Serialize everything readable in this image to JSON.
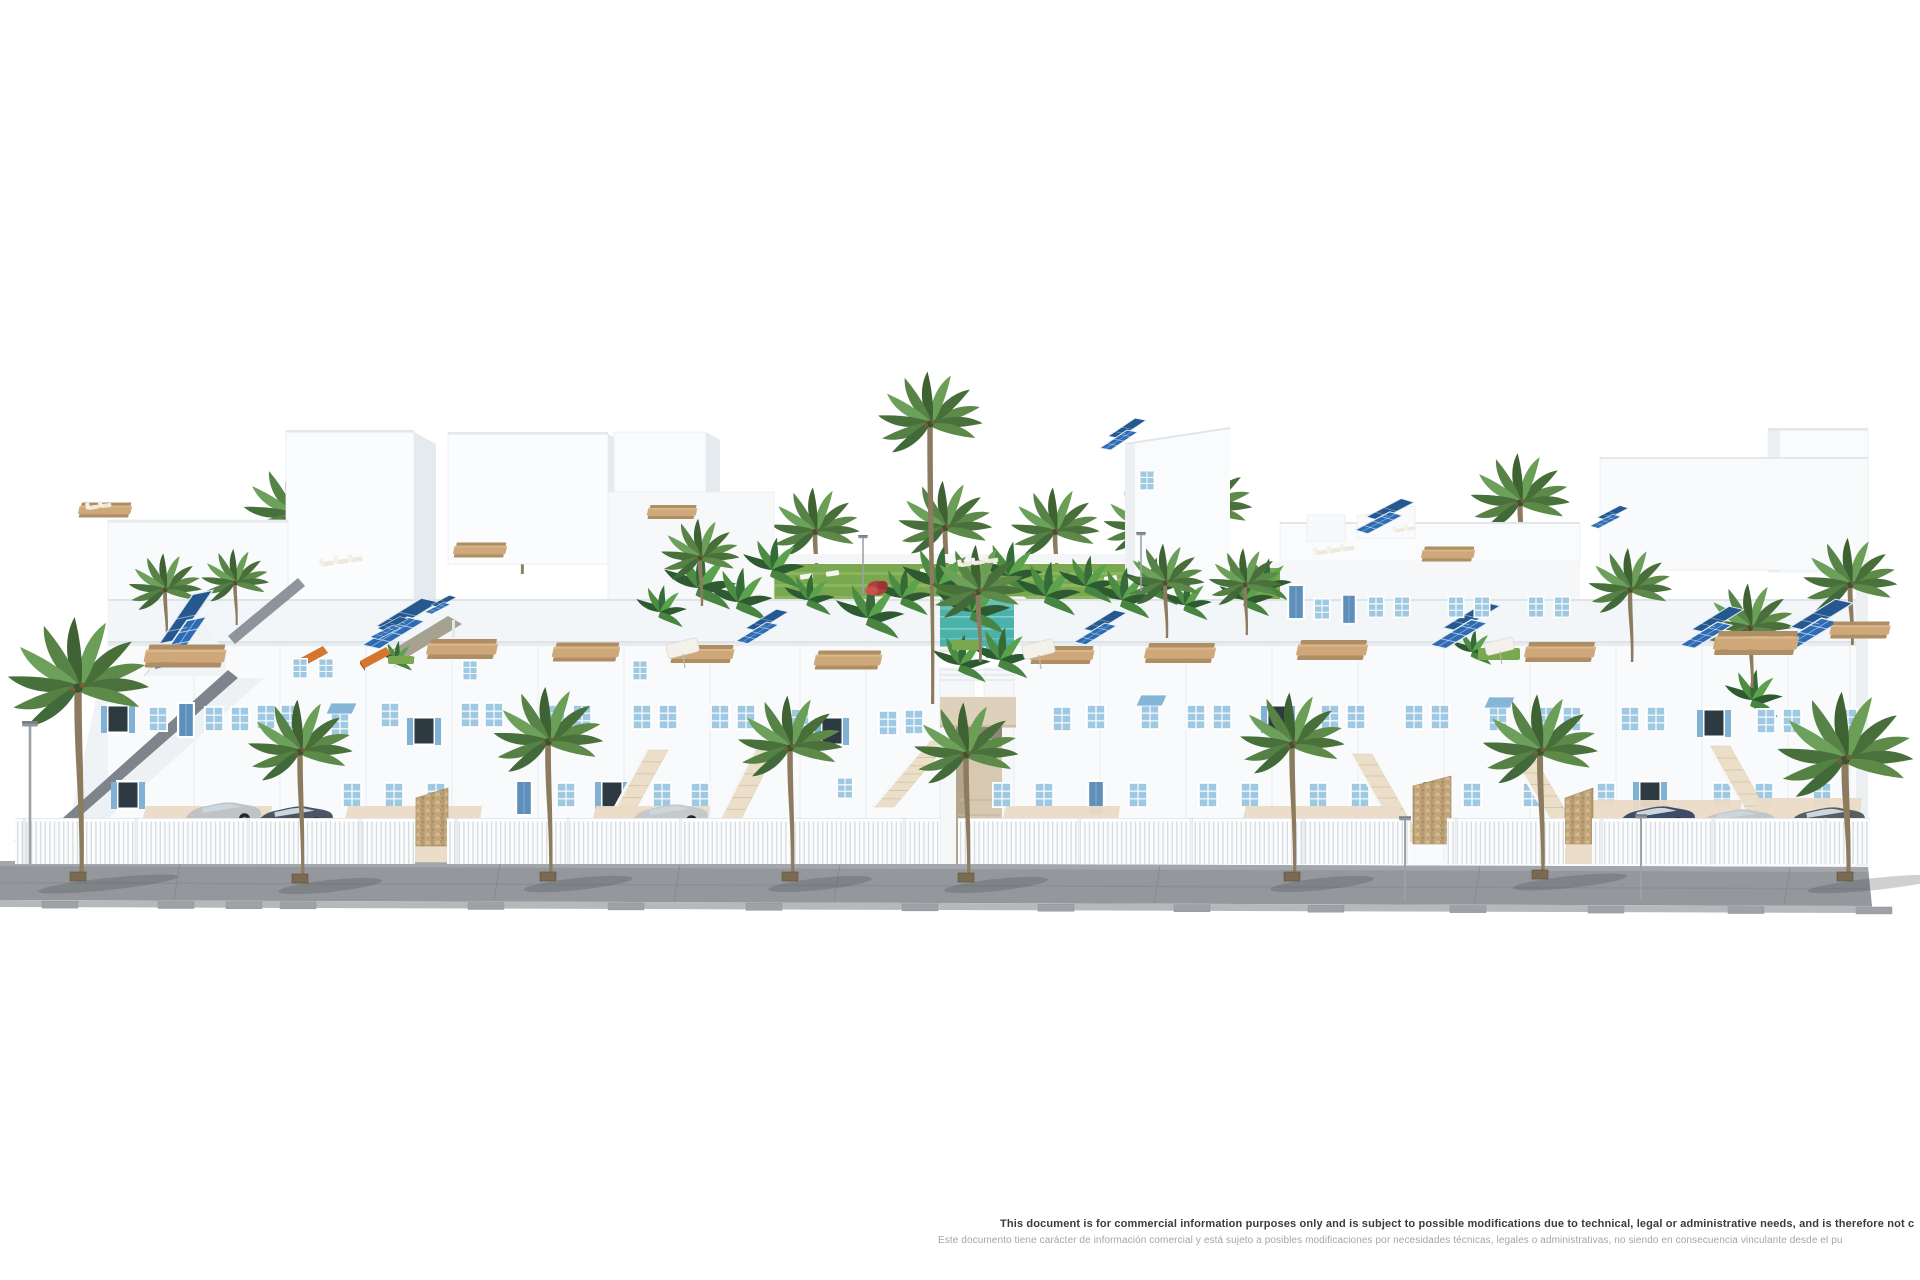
{
  "image": {
    "description": "3D architectural rendering of a white Mediterranean-style residential complex with blue shuttered windows, rooftop terraces with wooden dining tables, solar panels, a central landscaped courtyard with turquoise swimming pool, palm trees, white picket fence, driveways with parked cars and a gray paved sidewalk",
    "background": "#ffffff",
    "width": 1920,
    "height": 1280
  },
  "disclaimer": {
    "line1": "This document is for commercial information purposes only and is subject to possible modifications due to technical, legal or administrative needs, and is therefore not c",
    "line2": "Este documento tiene carácter de información comercial y está sujeto a posibles modificaciones por necesidades técnicas, legales o administrativas, no siendo en consecuencia vinculante desde el pu"
  },
  "palette": {
    "wall_white": "#f8fafb",
    "wall_band": "#f3f6f8",
    "wall_shade": "#e5eaee",
    "window_blue": "#9fc9e2",
    "shutter_blue": "#7fb2d4",
    "door_blue": "#5d8fba",
    "solar_blue": "#2d6cb4",
    "solar_dark": "#24588f",
    "palm_green": "#5d8a49",
    "palm_trunk": "#8d7b5f",
    "pool_teal": "#4db1ab",
    "lawn_green": "#7aa851",
    "terrace_sand": "#efe8da",
    "stair_sand": "#ecdfc9",
    "stone_tan": "#c5aa80",
    "road_gray": "#94979b",
    "curb_gray": "#b6b9bc",
    "wood_tan": "#cfa87a",
    "awning_orange": "#d4762e",
    "pergola_olive": "#a5a291"
  },
  "scene": {
    "palms_back": [
      [
        293,
        515,
        0.95,
        70
      ],
      [
        520,
        512,
        0.9,
        62
      ],
      [
        815,
        532,
        0.85,
        58
      ],
      [
        945,
        528,
        0.9,
        58
      ],
      [
        1055,
        532,
        0.85,
        55
      ],
      [
        1145,
        528,
        0.8,
        52
      ],
      [
        1205,
        508,
        0.9,
        60
      ],
      [
        1520,
        503,
        0.95,
        65
      ]
    ],
    "palms_mid": [
      [
        930,
        424,
        1.0,
        280
      ],
      [
        978,
        592,
        0.9,
        70
      ],
      [
        1165,
        583,
        0.75,
        55
      ],
      [
        700,
        558,
        0.75,
        48
      ],
      [
        165,
        590,
        0.7,
        48
      ],
      [
        235,
        583,
        0.65,
        42
      ],
      [
        1630,
        590,
        0.8,
        72
      ],
      [
        1750,
        628,
        0.85,
        60
      ],
      [
        1850,
        585,
        0.9,
        60
      ],
      [
        1245,
        585,
        0.7,
        50
      ]
    ],
    "palms_front": [
      [
        78,
        688,
        1.35,
        190
      ],
      [
        300,
        752,
        1.0,
        128
      ],
      [
        548,
        742,
        1.05,
        136
      ],
      [
        790,
        748,
        1.0,
        130
      ],
      [
        966,
        755,
        1.0,
        124
      ],
      [
        1292,
        745,
        1.0,
        133
      ],
      [
        1540,
        752,
        1.1,
        124
      ],
      [
        1845,
        760,
        1.3,
        118
      ]
    ],
    "bananas": [
      [
        698,
        588,
        1
      ],
      [
        738,
        602,
        0.9
      ],
      [
        772,
        570,
        0.85
      ],
      [
        808,
        600,
        0.7
      ],
      [
        868,
        618,
        0.95
      ],
      [
        902,
        598,
        0.8
      ],
      [
        938,
        586,
        1.05
      ],
      [
        972,
        612,
        1
      ],
      [
        1008,
        576,
        0.9
      ],
      [
        1046,
        596,
        0.9
      ],
      [
        1086,
        586,
        0.8
      ],
      [
        1122,
        600,
        0.85
      ],
      [
        1152,
        588,
        0.8
      ],
      [
        660,
        612,
        0.7
      ],
      [
        1185,
        605,
        0.7
      ],
      [
        960,
        665,
        0.8
      ],
      [
        1000,
        660,
        0.85
      ],
      [
        1245,
        600,
        0.75
      ],
      [
        1265,
        585,
        0.7
      ],
      [
        1472,
        652,
        0.6
      ],
      [
        396,
        660,
        0.5
      ],
      [
        1752,
        700,
        0.8
      ]
    ],
    "red_bushes": [
      [
        877,
        588,
        0.9
      ]
    ],
    "lawn_patches": [
      [
        952,
        640,
        30,
        10
      ],
      [
        1478,
        648,
        42,
        12
      ],
      [
        388,
        656,
        26,
        8
      ]
    ],
    "solar_arrays": [
      [
        153,
        670,
        1.3,
        -38
      ],
      [
        362,
        645,
        1.15,
        -14
      ],
      [
        736,
        641,
        0.78,
        -14
      ],
      [
        1074,
        642,
        0.78,
        -14
      ],
      [
        1430,
        645,
        1.05,
        -14
      ],
      [
        1680,
        645,
        0.95,
        -14
      ],
      [
        1776,
        646,
        1.15,
        -14
      ],
      [
        1100,
        448,
        0.7,
        -16
      ],
      [
        1355,
        530,
        0.85,
        -10
      ],
      [
        1590,
        526,
        0.55,
        -10
      ],
      [
        370,
        637,
        0.55,
        -10
      ],
      [
        425,
        612,
        0.45,
        -10
      ]
    ],
    "tables": [
      [
        185,
        656,
        1.15
      ],
      [
        462,
        649,
        1.0
      ],
      [
        586,
        652,
        0.95
      ],
      [
        702,
        654,
        0.9
      ],
      [
        848,
        660,
        0.95
      ],
      [
        1062,
        655,
        0.9
      ],
      [
        1180,
        653,
        1.0
      ],
      [
        1332,
        650,
        1.0
      ],
      [
        1560,
        652,
        1.0
      ],
      [
        1756,
        643,
        1.2
      ],
      [
        1860,
        630,
        0.85
      ],
      [
        480,
        550,
        0.75
      ],
      [
        672,
        512,
        0.7
      ],
      [
        105,
        510,
        0.75
      ],
      [
        1448,
        554,
        0.75
      ]
    ],
    "loungers": [
      [
        322,
        562,
        0.9,
        3
      ],
      [
        960,
        563,
        0.85,
        3
      ],
      [
        1316,
        551,
        0.85,
        3
      ],
      [
        1395,
        529,
        0.7,
        2
      ],
      [
        88,
        506,
        0.8,
        2
      ]
    ],
    "parasols": [
      [
        683,
        650,
        1
      ],
      [
        1039,
        651,
        1
      ],
      [
        1500,
        648,
        0.9
      ]
    ],
    "awnings_orange": [
      [
        297,
        660
      ],
      [
        360,
        661
      ]
    ],
    "windows": [
      [
        118,
        704,
        "s"
      ],
      [
        158,
        706,
        "p"
      ],
      [
        186,
        702,
        "d"
      ],
      [
        214,
        706,
        "p"
      ],
      [
        240,
        706,
        "p"
      ],
      [
        266,
        704,
        "p"
      ],
      [
        290,
        704,
        "p"
      ],
      [
        340,
        712,
        "a"
      ],
      [
        390,
        702,
        "p"
      ],
      [
        424,
        716,
        "s"
      ],
      [
        470,
        702,
        "p"
      ],
      [
        494,
        702,
        "p"
      ],
      [
        556,
        704,
        "p"
      ],
      [
        582,
        704,
        "p"
      ],
      [
        642,
        704,
        "p"
      ],
      [
        668,
        704,
        "p"
      ],
      [
        720,
        704,
        "p"
      ],
      [
        746,
        704,
        "p"
      ],
      [
        800,
        708,
        "p"
      ],
      [
        832,
        716,
        "s"
      ],
      [
        888,
        710,
        "p"
      ],
      [
        914,
        709,
        "p"
      ],
      [
        1062,
        706,
        "p"
      ],
      [
        1096,
        704,
        "p"
      ],
      [
        1150,
        704,
        "a"
      ],
      [
        1196,
        704,
        "p"
      ],
      [
        1222,
        704,
        "p"
      ],
      [
        1278,
        704,
        "s"
      ],
      [
        1330,
        704,
        "p"
      ],
      [
        1356,
        704,
        "p"
      ],
      [
        1414,
        704,
        "p"
      ],
      [
        1440,
        704,
        "p"
      ],
      [
        1498,
        706,
        "a"
      ],
      [
        1546,
        706,
        "p"
      ],
      [
        1572,
        706,
        "p"
      ],
      [
        1630,
        706,
        "p"
      ],
      [
        1656,
        706,
        "p"
      ],
      [
        1714,
        708,
        "s"
      ],
      [
        1766,
        708,
        "p"
      ],
      [
        1792,
        708,
        "p"
      ],
      [
        1848,
        708,
        "p"
      ],
      [
        1296,
        584,
        "d",
        1.0
      ],
      [
        1322,
        598,
        "p",
        0.85
      ],
      [
        1349,
        594,
        "d",
        0.85
      ],
      [
        1376,
        596,
        "p",
        0.85
      ],
      [
        1402,
        596,
        "p",
        0.85
      ],
      [
        1456,
        596,
        "p",
        0.85
      ],
      [
        1482,
        596,
        "p",
        0.85
      ],
      [
        1536,
        596,
        "p",
        0.85
      ],
      [
        1562,
        596,
        "p",
        0.85
      ],
      [
        300,
        658,
        "p",
        0.8
      ],
      [
        326,
        658,
        "p",
        0.8
      ],
      [
        470,
        660,
        "p",
        0.8
      ],
      [
        640,
        660,
        "p",
        0.8
      ],
      [
        1147,
        470,
        "p",
        0.8
      ],
      [
        128,
        780,
        "s"
      ],
      [
        352,
        782,
        "p"
      ],
      [
        394,
        782,
        "p"
      ],
      [
        436,
        782,
        "p"
      ],
      [
        524,
        780,
        "d"
      ],
      [
        566,
        782,
        "p"
      ],
      [
        612,
        780,
        "s"
      ],
      [
        662,
        782,
        "p"
      ],
      [
        700,
        782,
        "p"
      ],
      [
        845,
        777,
        "p",
        0.85
      ],
      [
        1002,
        782,
        "p"
      ],
      [
        1044,
        782,
        "p"
      ],
      [
        1096,
        780,
        "d"
      ],
      [
        1138,
        782,
        "p"
      ],
      [
        1208,
        782,
        "p"
      ],
      [
        1250,
        782,
        "p"
      ],
      [
        1318,
        782,
        "p"
      ],
      [
        1360,
        782,
        "p"
      ],
      [
        1430,
        780,
        "d"
      ],
      [
        1472,
        782,
        "p"
      ],
      [
        1532,
        782,
        "p"
      ],
      [
        1606,
        782,
        "p"
      ],
      [
        1650,
        780,
        "s"
      ],
      [
        1722,
        782,
        "p"
      ],
      [
        1764,
        782,
        "p"
      ],
      [
        1822,
        782,
        "p"
      ]
    ],
    "stairs": [
      [
        648,
        750,
        -52,
        95
      ],
      [
        756,
        750,
        -48,
        95
      ],
      [
        930,
        741,
        -56,
        66
      ],
      [
        1352,
        754,
        50,
        88
      ],
      [
        1510,
        750,
        54,
        92
      ],
      [
        1710,
        746,
        54,
        96
      ]
    ],
    "driveways": [
      [
        132,
        806,
        140,
        56
      ],
      [
        334,
        806,
        148,
        58
      ],
      [
        582,
        806,
        128,
        56
      ],
      [
        992,
        806,
        128,
        56
      ],
      [
        1232,
        806,
        168,
        58
      ],
      [
        1562,
        800,
        180,
        64
      ],
      [
        1742,
        798,
        120,
        66
      ]
    ],
    "stone_walls": [
      [
        416,
        788,
        32,
        58
      ],
      [
        1413,
        776,
        38,
        68
      ],
      [
        1565,
        788,
        28,
        56
      ]
    ],
    "cars": [
      [
        178,
        808,
        "#c0c3c6",
        -9
      ],
      [
        250,
        812,
        "#4b5563",
        -9
      ],
      [
        12,
        818,
        "#45516b",
        0
      ],
      [
        625,
        810,
        "#c6c9cc",
        -9
      ],
      [
        1612,
        812,
        "#3e4c6a",
        -9
      ],
      [
        1692,
        815,
        "#c3c6c9",
        -9
      ],
      [
        1782,
        813,
        "#585e66",
        -9
      ]
    ],
    "fence_segments": [
      [
        15,
        400
      ],
      [
        447,
        493
      ],
      [
        958,
        452
      ],
      [
        1447,
        118
      ],
      [
        1592,
        278
      ]
    ],
    "street_lamps": [
      [
        30,
        726,
        138,
        1
      ],
      [
        863,
        538,
        56,
        0.6
      ],
      [
        1141,
        535,
        56,
        0.6
      ],
      [
        1405,
        820,
        80,
        0.75
      ],
      [
        1641,
        818,
        82,
        0.75
      ]
    ],
    "curb_marks": [
      42,
      158,
      226,
      280,
      468,
      608,
      746,
      902,
      1038,
      1174,
      1308,
      1450,
      1588,
      1728,
      1856
    ],
    "road_joints": [
      180,
      500,
      680,
      840,
      1160,
      1480,
      1790
    ]
  }
}
